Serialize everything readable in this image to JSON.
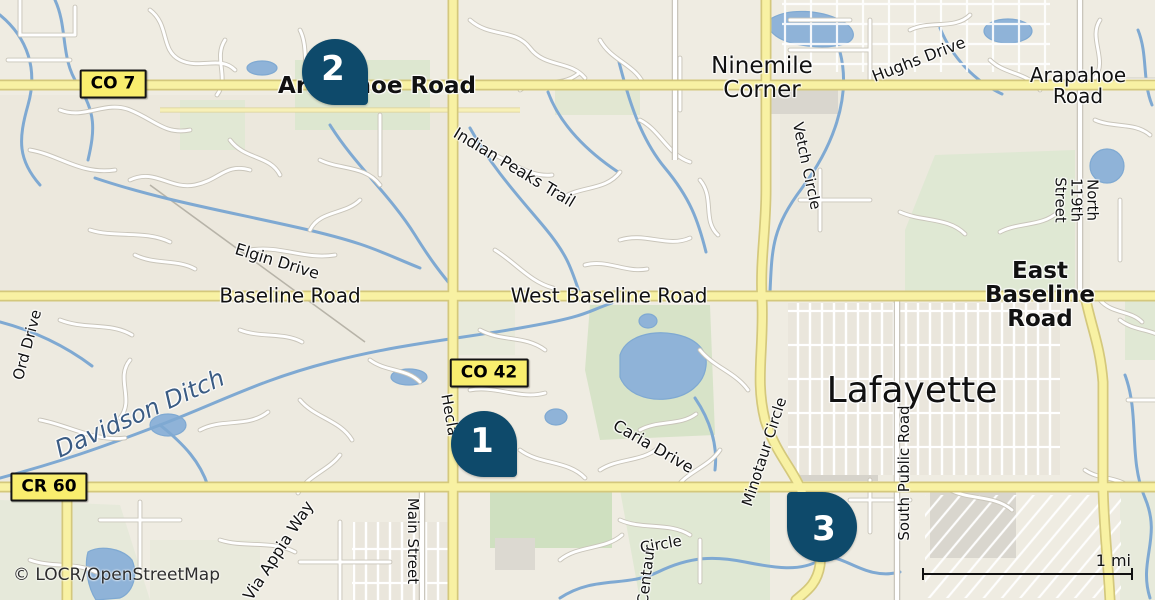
{
  "map": {
    "attribution": "© LOCR/OpenStreetMap",
    "scale_label": "1 mi"
  },
  "colors": {
    "land": "#efece2",
    "green": "#d7e3c8",
    "water": "#8fb3d8",
    "road_major_fill": "#f8f1a3",
    "badge_bg": "#f9ee6e",
    "marker": "#0e4a6b",
    "water_label_text": "#3b5c84"
  },
  "badges": {
    "co7": {
      "text": "CO 7"
    },
    "co42": {
      "text": "CO 42"
    },
    "cr60": {
      "text": "CR 60"
    }
  },
  "markers": [
    {
      "label": "1"
    },
    {
      "label": "2"
    },
    {
      "label": "3"
    }
  ],
  "labels": {
    "arapahoe_w": "Arapahoe Road",
    "ninemile": "Ninemile\nCorner",
    "hughs": "Hughs Drive",
    "arapahoe_e": "Arapahoe Road",
    "indian_peaks": "Indian Peaks Trail",
    "vetch": "Vetch Circle",
    "n119": "North 119th Street",
    "elgin": "Elgin Drive",
    "baseline": "Baseline Road",
    "west_baseline": "West Baseline Road",
    "east_baseline": "East Baseline Road",
    "ord": "Ord Drive",
    "davidson": "Davidson Ditch",
    "hecla": "Hecla",
    "lafayette": "Lafayette",
    "caria": "Caria Drive",
    "minotaur": "Minotaur Circle",
    "s_public": "South Public Road",
    "main_st": "Main Street",
    "via_appia": "Via Appia Way",
    "circle": "Circle",
    "centaur": "Centaur"
  }
}
